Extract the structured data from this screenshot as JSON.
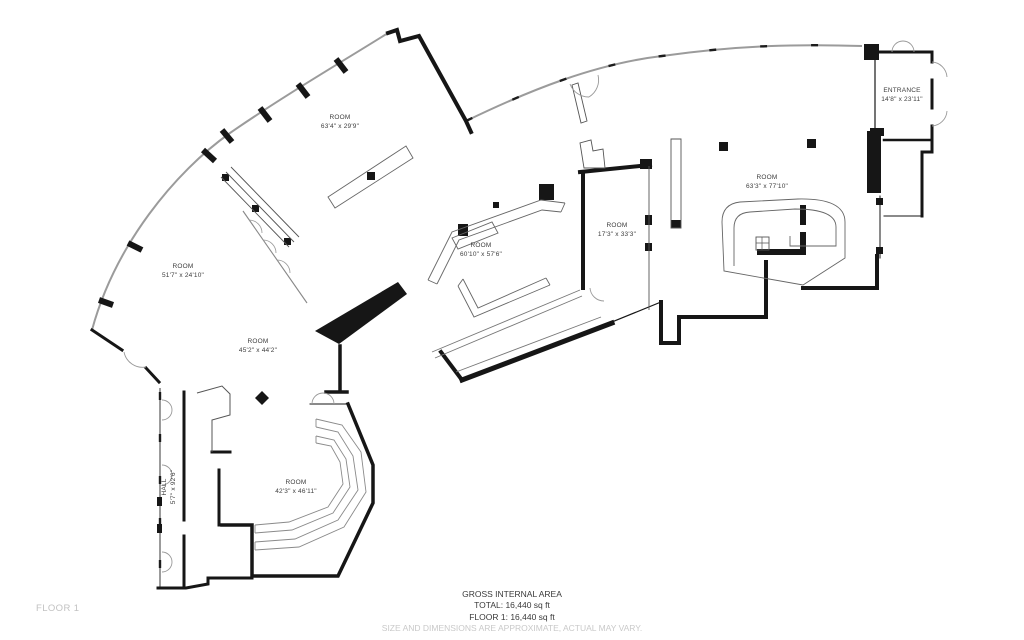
{
  "document_type": "floor-plan",
  "floor_tag": "FLOOR 1",
  "rooms": [
    {
      "id": "room-top-left",
      "name": "ROOM",
      "dims": "63'4\" x 29'9\""
    },
    {
      "id": "room-left",
      "name": "ROOM",
      "dims": "51'7\" x 24'10\""
    },
    {
      "id": "room-mid-left",
      "name": "ROOM",
      "dims": "45'2\" x 44'2\""
    },
    {
      "id": "room-bottom",
      "name": "ROOM",
      "dims": "42'3\" x 46'11\""
    },
    {
      "id": "hall",
      "name": "HALL",
      "dims": "5'7\" x 92'6\""
    },
    {
      "id": "room-center",
      "name": "ROOM",
      "dims": "60'10\" x 57'6\""
    },
    {
      "id": "room-mid-right",
      "name": "ROOM",
      "dims": "17'3\" x 33'3\""
    },
    {
      "id": "room-right",
      "name": "ROOM",
      "dims": "63'3\" x 77'10\""
    },
    {
      "id": "entrance",
      "name": "ENTRANCE",
      "dims": "14'8\" x 23'11\""
    }
  ],
  "footer": {
    "title": "GROSS INTERNAL AREA",
    "total": "TOTAL: 16,440 sq ft",
    "floor1": "FLOOR 1: 16,440 sq ft",
    "disclaimer": "SIZE AND DIMENSIONS ARE APPROXIMATE, ACTUAL MAY VARY."
  },
  "colors": {
    "wall": "#161616",
    "curtain_wall": "#9b9b9b",
    "interior_line": "#666666",
    "label_text": "#3d3d3d",
    "muted_text": "#c9c9c9",
    "background": "#ffffff"
  }
}
